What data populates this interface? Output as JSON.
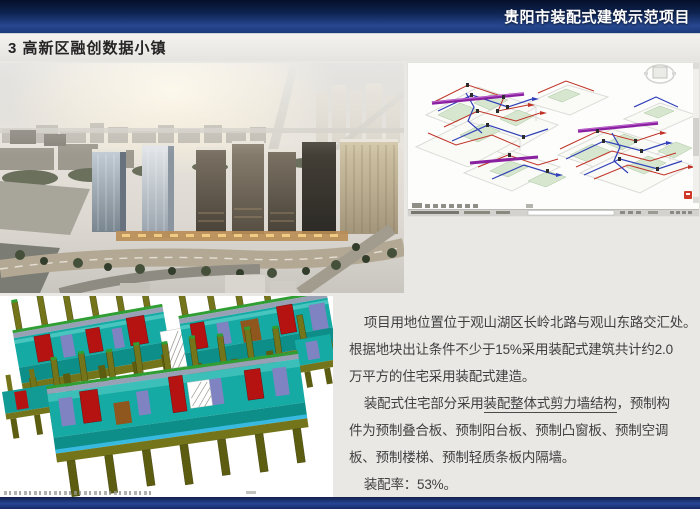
{
  "header": {
    "title": "贵阳市装配式建筑示范项目"
  },
  "section": {
    "title": "3 高新区融创数据小镇"
  },
  "description": {
    "line1": "项目用地位置位于观山湖区长岭北路与观山东路交汇处。",
    "line2": "根据地块出让条件不少于15%采用装配式建筑共计约2.0",
    "line3": "万平方的住宅采用装配式建造。",
    "line4_pre": "装配式住宅部分采用",
    "line4_underlined": "装配整体式剪力墙结构",
    "line4_post": "，预制构",
    "line5": "件为预制叠合板、预制阳台板、预制凸窗板、预制空调",
    "line6": "板、预制楼梯、预制轻质条板内隔墙。",
    "line7": "装配率：53%。"
  },
  "images": {
    "aerial_rendering": "project-aerial-rendering",
    "bim_mep_screenshot": "bim-mep-pipework-model",
    "precast_model": "precast-shear-wall-component-model"
  },
  "colors": {
    "header_blue_dark": "#0a1a3e",
    "header_blue": "#27478f",
    "slide_bg": "#e9e8e5",
    "body_text": "#3f3f3f",
    "pipe_red": "#c03327",
    "pipe_blue": "#3040b8",
    "pipe_purple": "#8a21a0",
    "floor_green": "#d7e7cf",
    "model_teal": "#16aaa4",
    "model_red": "#b51212",
    "model_olive": "#74751a",
    "model_purple": "#8083c2"
  }
}
